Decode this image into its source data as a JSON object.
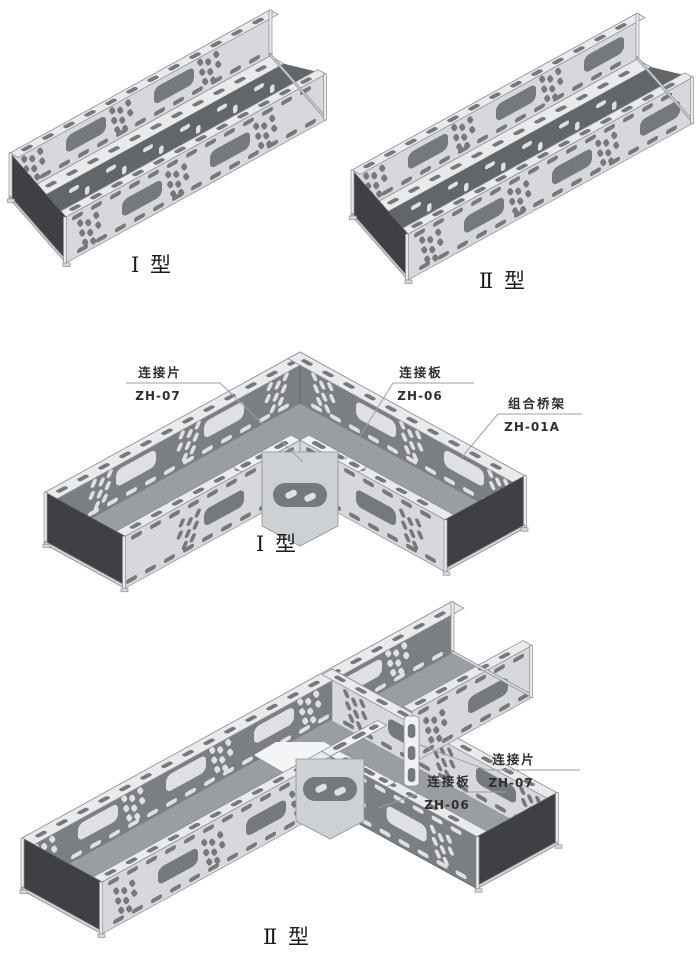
{
  "colors": {
    "background": "#ffffff",
    "faceLight": "#d6d8db",
    "faceDark": "#7b7e82",
    "flange": "#e8eaec",
    "strip": "#eff1f2",
    "floor": "#9a9da1",
    "interiorDark": "#636669",
    "endDark": "#3e4043",
    "holeDark": "#75787c",
    "holeLight": "#dee0e3",
    "plate": "#ced1d4",
    "outline": "#8d9094",
    "outlineDark": "#5f6266",
    "leader": "#9aa0a4",
    "text": "#2f2f2f",
    "labelText": "#1b1b1b"
  },
  "figures": {
    "straight_type1": {
      "label": "Ⅰ 型"
    },
    "straight_type2": {
      "label": "Ⅱ 型"
    },
    "elbow_type1": {
      "label": "Ⅰ 型",
      "callouts": {
        "piece": {
          "title": "连接片",
          "code": "ZH-07"
        },
        "plate": {
          "title": "连接板",
          "code": "ZH-06"
        },
        "tray": {
          "title": "组合桥架",
          "code": "ZH-01A"
        }
      }
    },
    "tee_type2": {
      "label": "Ⅱ 型",
      "callouts": {
        "piece": {
          "title": "连接片",
          "code": "ZH-07"
        },
        "plate": {
          "title": "连接板",
          "code": "ZH-06"
        }
      }
    }
  }
}
